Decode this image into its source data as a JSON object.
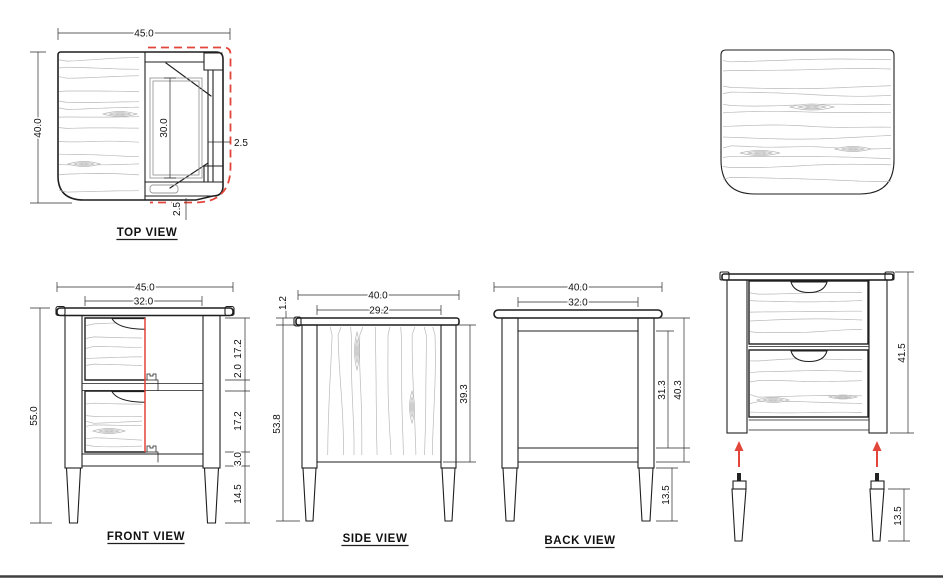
{
  "meta": {
    "accent_red": "#e2453a",
    "line_color": "#1f1f1f",
    "grain_color": "#b9b9b9"
  },
  "top_view": {
    "title": "TOP VIEW",
    "dim_width": "45.0",
    "dim_depth": "40.0",
    "dim_inner": "30.0",
    "dim_side_offset": "2.5",
    "dim_back_offset": "2.5"
  },
  "front_view": {
    "title": "FRONT VIEW",
    "dim_width": "45.0",
    "dim_drawer_width": "32.0",
    "dim_height": "55.0",
    "dim_drawer_top": "17.2",
    "dim_gap": "2.0",
    "dim_drawer_bottom": "17.2",
    "dim_rail": "3.0",
    "dim_leg": "14.5"
  },
  "side_view": {
    "title": "SIDE VIEW",
    "dim_width": "40.0",
    "dim_panel_width": "29.2",
    "dim_top_thickness": "1.2",
    "dim_height": "53.8",
    "dim_panel_height": "39.3"
  },
  "back_view": {
    "title": "BACK VIEW",
    "dim_width": "40.0",
    "dim_inner_width": "32.0",
    "dim_panel_height": "31.3",
    "dim_body_height": "40.3",
    "dim_leg": "13.5"
  },
  "assembly_view": {
    "dim_body_height": "41.5",
    "dim_leg_height": "13.5"
  }
}
